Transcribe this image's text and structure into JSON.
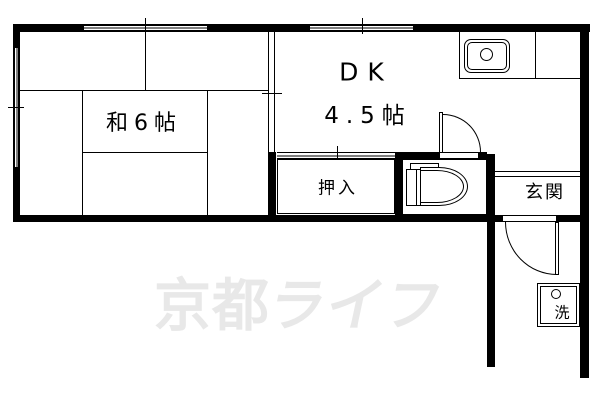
{
  "rooms": {
    "washitsu": {
      "label": "和6帖"
    },
    "dk": {
      "name": "DK",
      "size": "4.5帖"
    },
    "oshiire": {
      "label": "押入"
    },
    "genkan": {
      "label": "玄関"
    },
    "laundry": {
      "label": "洗"
    }
  },
  "watermark": {
    "text": "京都ライフ",
    "part1": "京都",
    "part2": "ライフ",
    "color": "#e8e8e8"
  },
  "colors": {
    "wall": "#000000",
    "background": "#ffffff"
  }
}
